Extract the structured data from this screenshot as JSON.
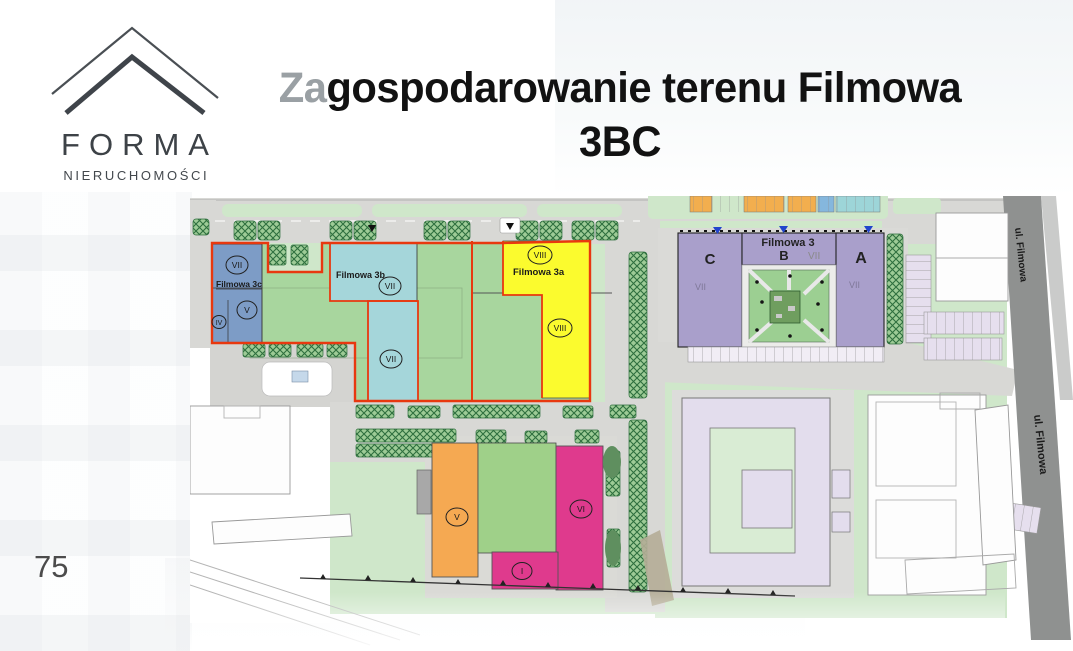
{
  "logo": {
    "name": "FORMA",
    "subtitle": "NIERUCHOMOŚCI"
  },
  "title": {
    "highlight": "Za",
    "line1": "gospodarowanie terenu Filmowa",
    "line2": "3BC"
  },
  "page_number": "75",
  "map": {
    "streets": {
      "upper": "ul. Filmowa",
      "lower": "ul. Filmowa"
    },
    "buildings": {
      "filmowa_3c": {
        "label": "Filmowa 3c",
        "floor_upper": "VII",
        "floor_mid": "V",
        "floor_low": "IV"
      },
      "filmowa_3b": {
        "label": "Filmowa 3b",
        "floor_upper": "VII",
        "floor_lower": "VII"
      },
      "filmowa_3a": {
        "label": "Filmowa 3a",
        "floor_upper": "VIII",
        "floor_lower": "VIII"
      },
      "filmowa_3": {
        "label": "Filmowa 3",
        "section_a": "A",
        "section_b": "B",
        "section_c": "C",
        "floor_b": "VII",
        "floor_c": "VII",
        "floor_a": "VII"
      },
      "building_v": {
        "floor": "V"
      },
      "building_vi": {
        "floor": "VI"
      },
      "building_i": {
        "floor": "I"
      }
    },
    "colors": {
      "filmowa_3c": "#7d9cc6",
      "filmowa_3b": "#a5d6da",
      "filmowa_3a": "#fbfb2e",
      "filmowa_3": "#a99fcb",
      "building_v": "#f5a952",
      "building_vi": "#df3a8d",
      "plot_outline": "#e8380f",
      "lawn": "#a8d69e",
      "greenery": "#cfe7ca",
      "road": "#d8d8d5",
      "street_dark": "#8f9190",
      "existing_building": "#e3dded"
    }
  }
}
